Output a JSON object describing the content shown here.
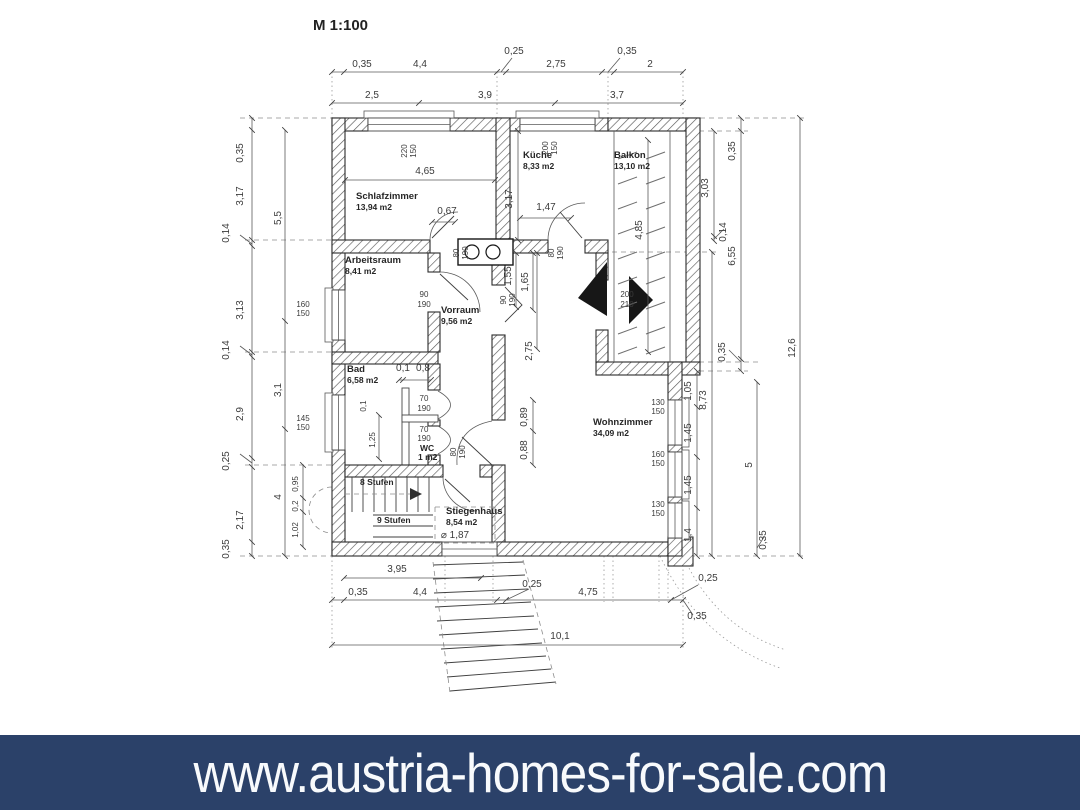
{
  "scale_label": "M 1:100",
  "banner": {
    "text": "www.austria-homes-for-sale.com",
    "bg_color": "#2b4169",
    "text_color": "#f8fafc"
  },
  "rooms": {
    "schlafzimmer": {
      "name": "Schlafzimmer",
      "area": "13,94 m2"
    },
    "kueche": {
      "name": "Küche",
      "area": "8,33 m2"
    },
    "balkon": {
      "name": "Balkon",
      "area": "13,10 m2"
    },
    "arbeitsraum": {
      "name": "Arbeitsraum",
      "area": "8,41 m2"
    },
    "vorraum": {
      "name": "Vorraum",
      "area": "9,56 m2"
    },
    "bad": {
      "name": "Bad",
      "area": "6,58 m2"
    },
    "wc": {
      "name": "WC",
      "area": "1 m2"
    },
    "wohnzimmer": {
      "name": "Wohnzimmer",
      "area": "34,09 m2"
    },
    "stiegenhaus": {
      "name": "Stiegenhaus",
      "area": "8,54 m2"
    }
  },
  "stairs": {
    "upper_label": "8 Stufen",
    "lower_label": "9 Stufen",
    "diameter": "⌀ 1,87"
  },
  "dims": {
    "top1": [
      "0,35",
      "4,4",
      "0,25",
      "2,75",
      "0,35",
      "2"
    ],
    "top2": [
      "2,5",
      "3,9",
      "3,7"
    ],
    "left_outer": [
      "0,35",
      "3,17",
      "0,14",
      "3,13",
      "0,14",
      "2,9",
      "0,25",
      "2,17",
      "0,35"
    ],
    "left_inner": [
      "5,5",
      "3,1",
      "4"
    ],
    "left_small": [
      "0,95",
      "0,2",
      "1,02"
    ],
    "bad": [
      "0,1",
      "0,8",
      "0,1",
      "1,25"
    ],
    "right": [
      "3,03",
      "0,14",
      "0,35",
      "6,55",
      "0,35",
      "1,05",
      "1,45",
      "1,45",
      "1,4",
      "8,73",
      "5",
      "0,35",
      "12,6",
      "0,35"
    ],
    "bottom": [
      "3,95",
      "0,35",
      "4,4",
      "0,25",
      "4,75",
      "0,25",
      "10,1"
    ],
    "interior": [
      "4,65",
      "0,67",
      "3,17",
      "1,47",
      "4,85",
      "1,55",
      "1,65",
      "2,75",
      "0,89",
      "0,88"
    ]
  },
  "openings": {
    "win_schlaf": [
      "220",
      "150"
    ],
    "win_kueche": [
      "200",
      "150"
    ],
    "door_balkon": [
      "200",
      "210"
    ],
    "win_arbeits": [
      "160",
      "150"
    ],
    "win_bad": [
      "145",
      "150"
    ],
    "win_wohn1": [
      "130",
      "150"
    ],
    "win_wohn2": [
      "160",
      "150"
    ],
    "win_wohn3": [
      "130",
      "150"
    ],
    "door_schlaf": [
      "80",
      "190"
    ],
    "door_kueche": [
      "80",
      "190"
    ],
    "door_stiege": [
      "80",
      "190"
    ],
    "door_arbeits": [
      "90",
      "190"
    ],
    "door_wohn": [
      "90",
      "190"
    ],
    "door_bad": [
      "70",
      "190"
    ],
    "door_wc": [
      "70",
      "190"
    ]
  }
}
